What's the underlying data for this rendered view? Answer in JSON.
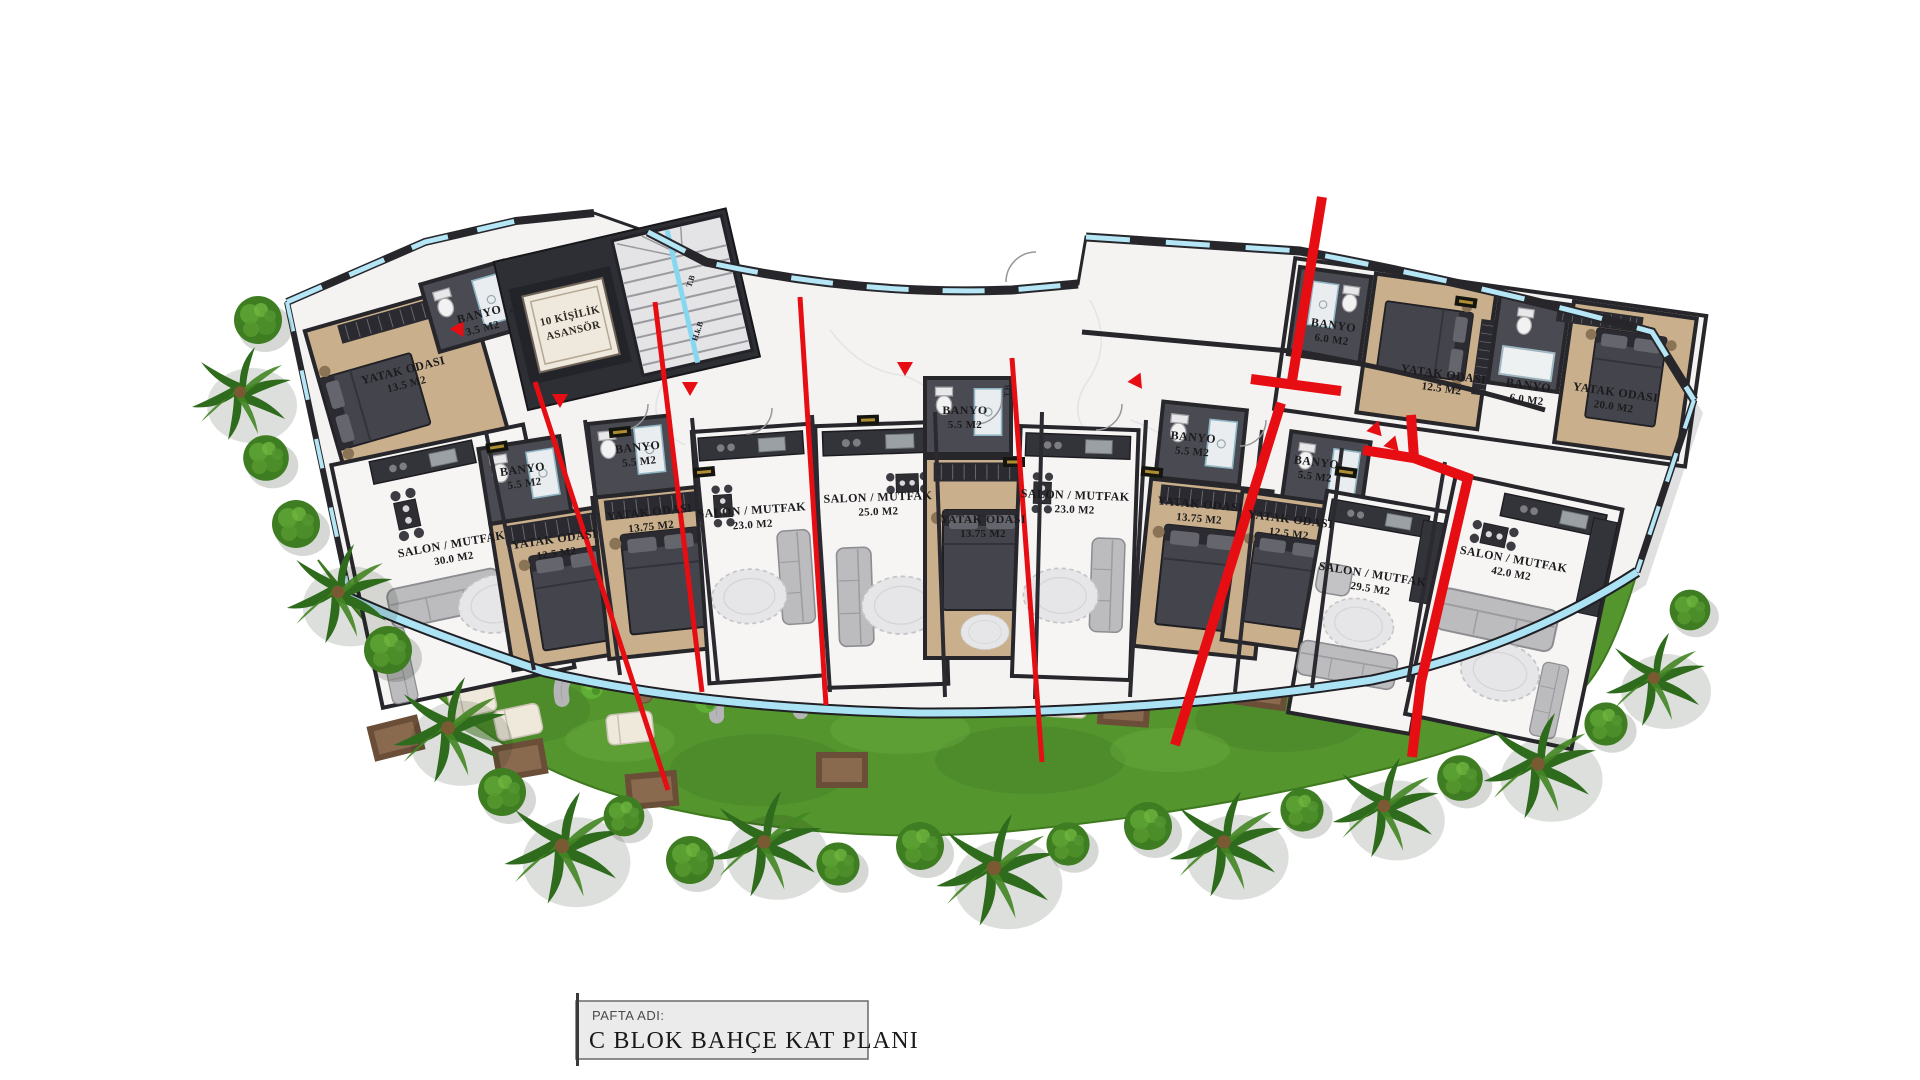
{
  "title_block": {
    "label": "PAFTA ADI:",
    "title": "C BLOK BAHÇE KAT PLANI"
  },
  "plan": {
    "elevator": {
      "line1": "10 KİŞİLİK",
      "line2": "ASANSÖR"
    },
    "rooms": [
      {
        "name": "YATAK ODASI",
        "area": "13.5 M2"
      },
      {
        "name": "BANYO",
        "area": "3.5 M2"
      },
      {
        "name": "SALON / MUTFAK",
        "area": "30.0 M2"
      },
      {
        "name": "BANYO",
        "area": "5.5 M2"
      },
      {
        "name": "YATAK ODASI",
        "area": "12.5 M2"
      },
      {
        "name": "BANYO",
        "area": "5.5 M2"
      },
      {
        "name": "YATAK ODASI",
        "area": "13.75 M2"
      },
      {
        "name": "SALON / MUTFAK",
        "area": "23.0 M2"
      },
      {
        "name": "SALON / MUTFAK",
        "area": "25.0 M2"
      },
      {
        "name": "BANYO",
        "area": "5.5 M2"
      },
      {
        "name": "YATAK ODASI",
        "area": "13.75 M2"
      },
      {
        "name": "SALON / MUTFAK",
        "area": "23.0 M2"
      },
      {
        "name": "BANYO",
        "area": "5.5 M2"
      },
      {
        "name": "YATAK ODASI",
        "area": "13.75 M2"
      },
      {
        "name": "BANYO",
        "area": "5.5 M2"
      },
      {
        "name": "YATAK ODASI",
        "area": "12.5 M2"
      },
      {
        "name": "SALON / MUTFAK",
        "area": "29.5 M2"
      },
      {
        "name": "BANYO",
        "area": "6.0 M2"
      },
      {
        "name": "YATAK ODASI",
        "area": "12.5 M2"
      },
      {
        "name": "BANYO",
        "area": "6.0 M2"
      },
      {
        "name": "YATAK ODASI",
        "area": "20.0 M2"
      },
      {
        "name": "SALON / MUTFAK",
        "area": "42.0 M2"
      }
    ],
    "wall_tags": [
      "T.B",
      "T.B",
      "H.k.B",
      "T.B"
    ],
    "colors": {
      "section_red": "#e60e13",
      "glass_cyan": "#b5e6f6",
      "grass_green": "#55952e",
      "wood_floor": "#c9af8b",
      "wall_dark": "#26262b",
      "marble": "#f4f3f2"
    }
  }
}
